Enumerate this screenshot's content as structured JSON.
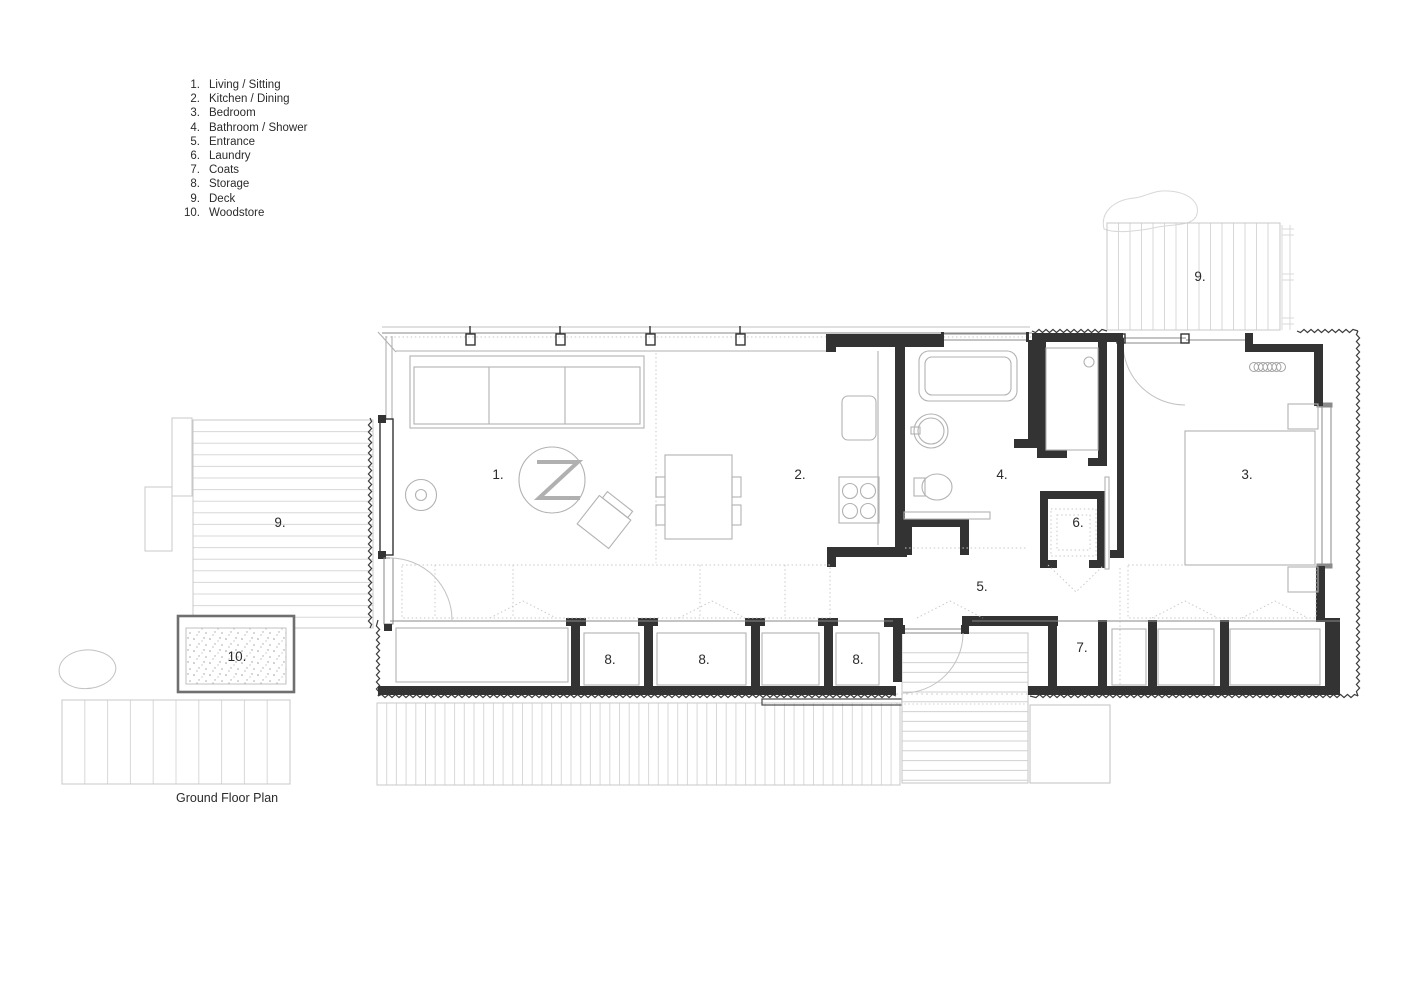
{
  "legend": {
    "items": [
      {
        "number": "1.",
        "label": "Living / Sitting"
      },
      {
        "number": "2.",
        "label": "Kitchen / Dining"
      },
      {
        "number": "3.",
        "label": "Bedroom"
      },
      {
        "number": "4.",
        "label": "Bathroom / Shower"
      },
      {
        "number": "5.",
        "label": "Entrance"
      },
      {
        "number": "6.",
        "label": "Laundry"
      },
      {
        "number": "7.",
        "label": "Coats"
      },
      {
        "number": "8.",
        "label": "Storage"
      },
      {
        "number": "9.",
        "label": "Deck"
      },
      {
        "number": "10.",
        "label": "Woodstore"
      }
    ]
  },
  "caption": "Ground Floor Plan",
  "plan": {
    "labels": {
      "living": "1.",
      "kitchen": "2.",
      "bedroom": "3.",
      "bathroom": "4.",
      "entrance": "5.",
      "laundry": "6.",
      "coats": "7.",
      "storage_a": "8.",
      "storage_b": "8.",
      "storage_c": "8.",
      "deck_left": "9.",
      "deck_top": "9.",
      "woodstore": "10."
    },
    "colors": {
      "wall": "#333333",
      "medium_line": "#8a8a8a",
      "furniture_line": "#b2b2b2",
      "deck_line": "#d8d8d8",
      "text": "#2b2b2b",
      "background": "#ffffff"
    }
  }
}
